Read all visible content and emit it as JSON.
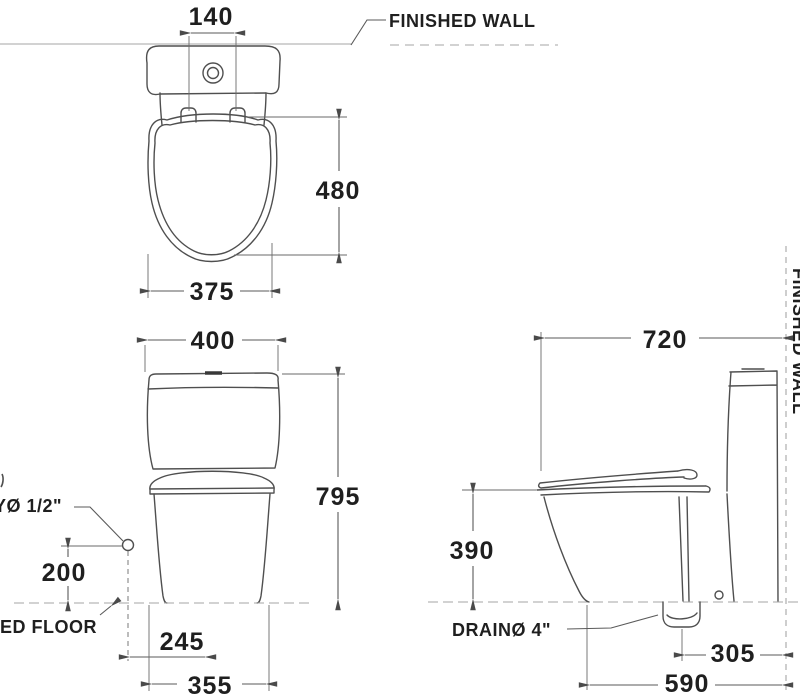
{
  "labels": {
    "finished_wall": "FINISHED WALL",
    "finished_wall_side": "FINISHED WALL",
    "finished_floor": "ED FLOOR",
    "water_supply": "YØ 1/2\"",
    "drain": "DRAINØ 4\""
  },
  "dimensions": {
    "top_view": {
      "flush_button_width": "140",
      "seat_depth": "480",
      "seat_width": "375"
    },
    "front_view": {
      "tank_width": "400",
      "overall_height": "795",
      "supply_height": "200",
      "supply_offset": "245",
      "base_width": "355"
    },
    "side_view": {
      "overall_depth": "720",
      "rim_height": "390",
      "drain_to_wall": "305",
      "front_to_wall": "590"
    }
  },
  "colors": {
    "outline": "#4f4f4f",
    "dimension": "#5a5a5a",
    "faint": "#a5a5a5",
    "text": "#1f1f1f",
    "background": "#ffffff"
  }
}
